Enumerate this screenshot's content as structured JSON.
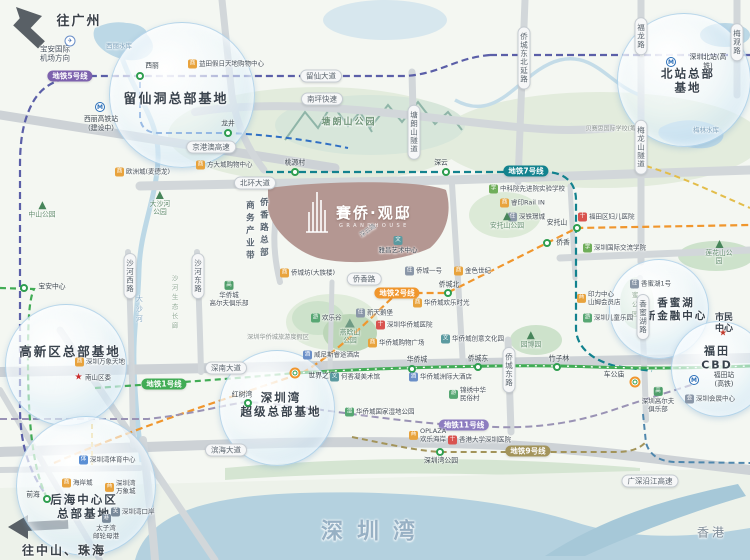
{
  "project": {
    "name": "賽侨·观邸",
    "en": "GRANDHOUSE",
    "road_label": "深云路"
  },
  "icon_glyphs": {
    "mall": "商",
    "res": "住",
    "school": "学",
    "culture": "文",
    "hotel": "酒",
    "hosp": "十",
    "fun": "游",
    "sport": "体",
    "port": "关",
    "ship": "港",
    "golf": "高",
    "wet": "湿",
    "conv": "会",
    "star": "★",
    "plane": "✈"
  },
  "colors": {
    "metro5": "#7d62ae",
    "metro7": "#12828e",
    "metro2": "#f0962d",
    "metro1": "#41ac55",
    "metro11": "#8d7cc0",
    "metro9": "#a3945a",
    "station_ring": "#2e9e4f",
    "sea": "#b4d1df"
  },
  "bubbles": [
    {
      "x": 182,
      "y": 95,
      "r": 72
    },
    {
      "x": 684,
      "y": 80,
      "r": 66
    },
    {
      "x": 66,
      "y": 365,
      "r": 60
    },
    {
      "x": 277,
      "y": 408,
      "r": 57
    },
    {
      "x": 86,
      "y": 486,
      "r": 69
    },
    {
      "x": 659,
      "y": 309,
      "r": 49
    },
    {
      "x": 719,
      "y": 369,
      "r": 47
    }
  ],
  "texts": [
    {
      "t": "往广州",
      "x": 79,
      "y": 22,
      "fs": 13,
      "cls": "compass"
    },
    {
      "t": "往中山、珠海",
      "x": 64,
      "y": 551,
      "fs": 12,
      "cls": "compass"
    },
    {
      "t": "香港",
      "x": 712,
      "y": 533,
      "fs": 12,
      "cls": "hk"
    },
    {
      "t": "深圳湾",
      "x": 375,
      "y": 532,
      "fs": 22,
      "cls": "bay"
    },
    {
      "t": "宝安国际\n机场方向",
      "x": 55,
      "y": 54,
      "fs": 7.5,
      "cls": "small-dark"
    },
    {
      "t": "留仙洞总部基地",
      "x": 176,
      "y": 100,
      "fs": 13,
      "cls": "bub"
    },
    {
      "t": "北站总部基地",
      "x": 688,
      "y": 81,
      "fs": 11.5,
      "cls": "bub"
    },
    {
      "t": "高新区总部基地",
      "x": 70,
      "y": 352,
      "fs": 12.5,
      "cls": "bub"
    },
    {
      "t": "深圳湾\n超级总部基地",
      "x": 281,
      "y": 405,
      "fs": 11.5,
      "cls": "bub"
    },
    {
      "t": "后海中心区\n总部基地",
      "x": 84,
      "y": 507,
      "fs": 11.5,
      "cls": "bub"
    },
    {
      "t": "香蜜湖\n新金融中心",
      "x": 676,
      "y": 310,
      "fs": 10.5,
      "cls": "bub"
    },
    {
      "t": "福田CBD",
      "x": 717,
      "y": 358,
      "fs": 11,
      "cls": "bub"
    },
    {
      "t": "塘朗山公园",
      "x": 349,
      "y": 123,
      "fs": 9,
      "cls": "park"
    },
    {
      "t": "西丽水库",
      "x": 119,
      "y": 46,
      "fs": 6.5,
      "cls": "water"
    },
    {
      "t": "梅林水库",
      "x": 706,
      "y": 130,
      "fs": 6.5,
      "cls": "water"
    },
    {
      "t": "大沙河",
      "x": 139,
      "y": 310,
      "fs": 7,
      "cls": "vwater"
    },
    {
      "t": "沙河生态长廊",
      "x": 174,
      "y": 303,
      "fs": 6.5,
      "cls": "vpark"
    },
    {
      "t": "香蜜公园",
      "x": 634,
      "y": 301,
      "fs": 6.5,
      "cls": "vpark"
    },
    {
      "t": "商务产业带",
      "x": 249,
      "y": 232,
      "fs": 8.5,
      "cls": "vbelt"
    },
    {
      "t": "侨香路总部",
      "x": 263,
      "y": 229,
      "fs": 8.5,
      "cls": "vbelt"
    },
    {
      "t": "贝赛思国际学校(筹)",
      "x": 612,
      "y": 129,
      "fs": 6,
      "cls": "tiny"
    },
    {
      "t": "深圳华侨城旅游度假区",
      "x": 278,
      "y": 338,
      "fs": 6.2,
      "cls": "tiny"
    },
    {
      "t": "市民中心",
      "x": 724,
      "y": 324,
      "fs": 9,
      "cls": "civic"
    },
    {
      "t": "★",
      "x": 723,
      "y": 334,
      "fs": 9,
      "cls": "star"
    },
    {
      "t": "深云路",
      "x": 368,
      "y": 231,
      "fs": 6,
      "cls": "diag"
    }
  ],
  "road_pills": [
    {
      "t": "留仙大道",
      "x": 321,
      "y": 76
    },
    {
      "t": "南坪快速",
      "x": 322,
      "y": 99
    },
    {
      "t": "京港澳高速",
      "x": 211,
      "y": 147
    },
    {
      "t": "北环大道",
      "x": 255,
      "y": 183
    },
    {
      "t": "侨香路",
      "x": 364,
      "y": 279
    },
    {
      "t": "深南大道",
      "x": 226,
      "y": 368
    },
    {
      "t": "滨海大道",
      "x": 226,
      "y": 450
    },
    {
      "t": "广深沿江高速",
      "x": 650,
      "y": 481
    }
  ],
  "road_pills_v": [
    {
      "t": "沙河西路",
      "x": 130,
      "y": 276
    },
    {
      "t": "沙河东路",
      "x": 198,
      "y": 276
    },
    {
      "t": "侨城东路",
      "x": 509,
      "y": 370
    },
    {
      "t": "香蜜湖路",
      "x": 643,
      "y": 317
    },
    {
      "t": "侨城东北延路",
      "x": 524,
      "y": 58
    },
    {
      "t": "福龙路",
      "x": 641,
      "y": 36
    },
    {
      "t": "梅龙山隧道",
      "x": 641,
      "y": 147
    },
    {
      "t": "塘朗山隧道",
      "x": 414,
      "y": 132
    },
    {
      "t": "梅观路",
      "x": 737,
      "y": 42
    }
  ],
  "metro_pills": [
    {
      "t": "地铁5号线",
      "x": 70,
      "y": 76,
      "c": "#7d62ae"
    },
    {
      "t": "地铁7号线",
      "x": 526,
      "y": 171,
      "c": "#12828e"
    },
    {
      "t": "地铁2号线",
      "x": 397,
      "y": 293,
      "c": "#f0962d"
    },
    {
      "t": "地铁1号线",
      "x": 164,
      "y": 384,
      "c": "#41ac55"
    },
    {
      "t": "地铁11号线",
      "x": 464,
      "y": 425,
      "c": "#8d7cc0"
    },
    {
      "t": "地铁9号线",
      "x": 528,
      "y": 451,
      "c": "#a3945a"
    }
  ],
  "stations": [
    {
      "t": "西丽",
      "x": 140,
      "y": 76,
      "lx": 152,
      "ly": 66,
      "type": "s"
    },
    {
      "t": "龙井",
      "x": 228,
      "y": 133,
      "lx": 228,
      "ly": 124,
      "type": "s"
    },
    {
      "t": "宝安中心",
      "x": 24,
      "y": 288,
      "lx": 52,
      "ly": 287,
      "type": "s"
    },
    {
      "t": "桃源村",
      "x": 295,
      "y": 172,
      "lx": 295,
      "ly": 163,
      "type": "s"
    },
    {
      "t": "深云",
      "x": 446,
      "y": 172,
      "lx": 441,
      "ly": 163,
      "type": "s"
    },
    {
      "t": "安托山",
      "x": 577,
      "y": 228,
      "lx": 557,
      "ly": 223,
      "type": "s"
    },
    {
      "t": "侨香",
      "x": 547,
      "y": 243,
      "lx": 563,
      "ly": 243,
      "type": "s"
    },
    {
      "t": "侨城北",
      "x": 448,
      "y": 293,
      "lx": 449,
      "ly": 285,
      "type": "s"
    },
    {
      "t": "华侨城",
      "x": 412,
      "y": 369,
      "lx": 417,
      "ly": 360,
      "type": "s"
    },
    {
      "t": "侨城东",
      "x": 478,
      "y": 367,
      "lx": 478,
      "ly": 359,
      "type": "s"
    },
    {
      "t": "竹子林",
      "x": 557,
      "y": 367,
      "lx": 559,
      "ly": 359,
      "type": "s"
    },
    {
      "t": "红树湾",
      "x": 248,
      "y": 403,
      "lx": 242,
      "ly": 395,
      "type": "s"
    },
    {
      "t": "前海",
      "x": 47,
      "y": 499,
      "lx": 33,
      "ly": 495,
      "type": "s"
    },
    {
      "t": "深圳湾公园",
      "x": 440,
      "y": 452,
      "lx": 441,
      "ly": 461,
      "type": "s"
    },
    {
      "t": "世界之窗",
      "x": 295,
      "y": 373,
      "lx": 322,
      "ly": 376,
      "type": "i"
    },
    {
      "t": "车公庙",
      "x": 635,
      "y": 371,
      "lx": 614,
      "ly": 375,
      "type": "i"
    },
    {
      "t": "深圳北站(高铁)",
      "x": 671,
      "y": 62,
      "lx": 708,
      "ly": 62,
      "type": "m"
    },
    {
      "t": "福田站(高铁)",
      "x": 694,
      "y": 380,
      "lx": 724,
      "ly": 380,
      "type": "m"
    },
    {
      "t": "西丽高铁站\n（建设中）",
      "x": 100,
      "y": 107,
      "lx": 101,
      "ly": 124,
      "type": "m"
    }
  ],
  "pois": [
    {
      "i": "mall",
      "t": "益田假日天地购物中心",
      "x": 188,
      "y": 64
    },
    {
      "i": "mall",
      "t": "欧洲城(麦德龙)",
      "x": 115,
      "y": 172
    },
    {
      "i": "mall",
      "t": "方大城购物中心",
      "x": 196,
      "y": 165
    },
    {
      "i": "school",
      "t": "中科院先进院实验学校",
      "x": 489,
      "y": 189
    },
    {
      "i": "mall",
      "t": "睿印Rail IN",
      "x": 500,
      "y": 203
    },
    {
      "i": "res",
      "t": "深铁璟城",
      "x": 508,
      "y": 217
    },
    {
      "i": "hosp",
      "t": "福田区妇儿医院",
      "x": 578,
      "y": 217
    },
    {
      "i": "school",
      "t": "深圳国际交流学院",
      "x": 583,
      "y": 248
    },
    {
      "i": "res",
      "t": "香蜜湖1号",
      "x": 630,
      "y": 284
    },
    {
      "i": "mall",
      "t": "印力中心\n山姆会员店",
      "x": 577,
      "y": 298
    },
    {
      "i": "fun",
      "t": "深圳儿童乐园",
      "x": 583,
      "y": 318
    },
    {
      "i": "mall",
      "t": "侨城坊(大族楼)",
      "x": 280,
      "y": 273
    },
    {
      "i": "res",
      "t": "侨城一号",
      "x": 405,
      "y": 271
    },
    {
      "i": "mall",
      "t": "金色世纪",
      "x": 454,
      "y": 271
    },
    {
      "i": "mall",
      "t": "华侨城欢乐时光",
      "x": 413,
      "y": 303
    },
    {
      "i": "fun",
      "t": "欢乐谷",
      "x": 311,
      "y": 318
    },
    {
      "i": "res",
      "t": "新天鹅堡",
      "x": 356,
      "y": 313
    },
    {
      "i": "hosp",
      "t": "深圳华侨城医院",
      "x": 376,
      "y": 325
    },
    {
      "i": "mall",
      "t": "华侨城购物广场",
      "x": 368,
      "y": 343
    },
    {
      "i": "culture",
      "t": "华侨城创意文化园",
      "x": 441,
      "y": 339
    },
    {
      "i": "hotel",
      "t": "威尼斯睿途酒店",
      "x": 303,
      "y": 355
    },
    {
      "i": "culture",
      "t": "何香凝美术馆",
      "x": 330,
      "y": 377
    },
    {
      "i": "hotel",
      "t": "华侨城洲际大酒店",
      "x": 409,
      "y": 377
    },
    {
      "i": "fun",
      "t": "锦绣中华\n民俗村",
      "x": 449,
      "y": 394
    },
    {
      "i": "wet",
      "t": "华侨城国家湿地公园",
      "x": 345,
      "y": 412
    },
    {
      "i": "mall",
      "t": "OPLAZA\n欢乐海岸",
      "x": 409,
      "y": 435
    },
    {
      "i": "hosp",
      "t": "香港大学深圳医院",
      "x": 448,
      "y": 440
    },
    {
      "i": "sport",
      "t": "深圳湾体育中心",
      "x": 79,
      "y": 460
    },
    {
      "i": "mall",
      "t": "海岸城",
      "x": 62,
      "y": 483
    },
    {
      "i": "mall",
      "t": "深圳湾\n万象城",
      "x": 105,
      "y": 487
    },
    {
      "i": "port",
      "t": "深圳湾口岸",
      "x": 111,
      "y": 512
    },
    {
      "i": "mall",
      "t": "深圳万象天地",
      "x": 75,
      "y": 362
    },
    {
      "i": "conv",
      "t": "深圳会展中心",
      "x": 685,
      "y": 399
    },
    {
      "i": "star",
      "t": "南山区委",
      "x": 74,
      "y": 378
    },
    {
      "i": "ship",
      "t": "太子湾\n邮轮母港",
      "x": 106,
      "y": 527,
      "col": 1
    },
    {
      "i": "golf",
      "t": "华侨城\n高尔夫俱乐部",
      "x": 229,
      "y": 294,
      "col": 1
    },
    {
      "i": "golf",
      "t": "深圳高尔夫\n俱乐部",
      "x": 658,
      "y": 400,
      "col": 1
    },
    {
      "i": "culture",
      "t": "雅昌艺术中心",
      "x": 398,
      "y": 245,
      "col": 1
    },
    {
      "i": "plane",
      "t": "",
      "x": 70,
      "y": 41,
      "col": 1
    }
  ],
  "parks": [
    {
      "t": "中山公园",
      "x": 42,
      "y": 210,
      "i": "tree"
    },
    {
      "t": "大沙河\n公园",
      "x": 160,
      "y": 204,
      "i": "tree"
    },
    {
      "t": "安托山公园",
      "x": 507,
      "y": 221,
      "i": "tree"
    },
    {
      "t": "园博园",
      "x": 531,
      "y": 340,
      "i": "tree"
    },
    {
      "t": "莲花山公园",
      "x": 719,
      "y": 253,
      "i": "tree"
    },
    {
      "t": "燕晗山\n公园",
      "x": 350,
      "y": 332,
      "i": "mtn"
    }
  ]
}
